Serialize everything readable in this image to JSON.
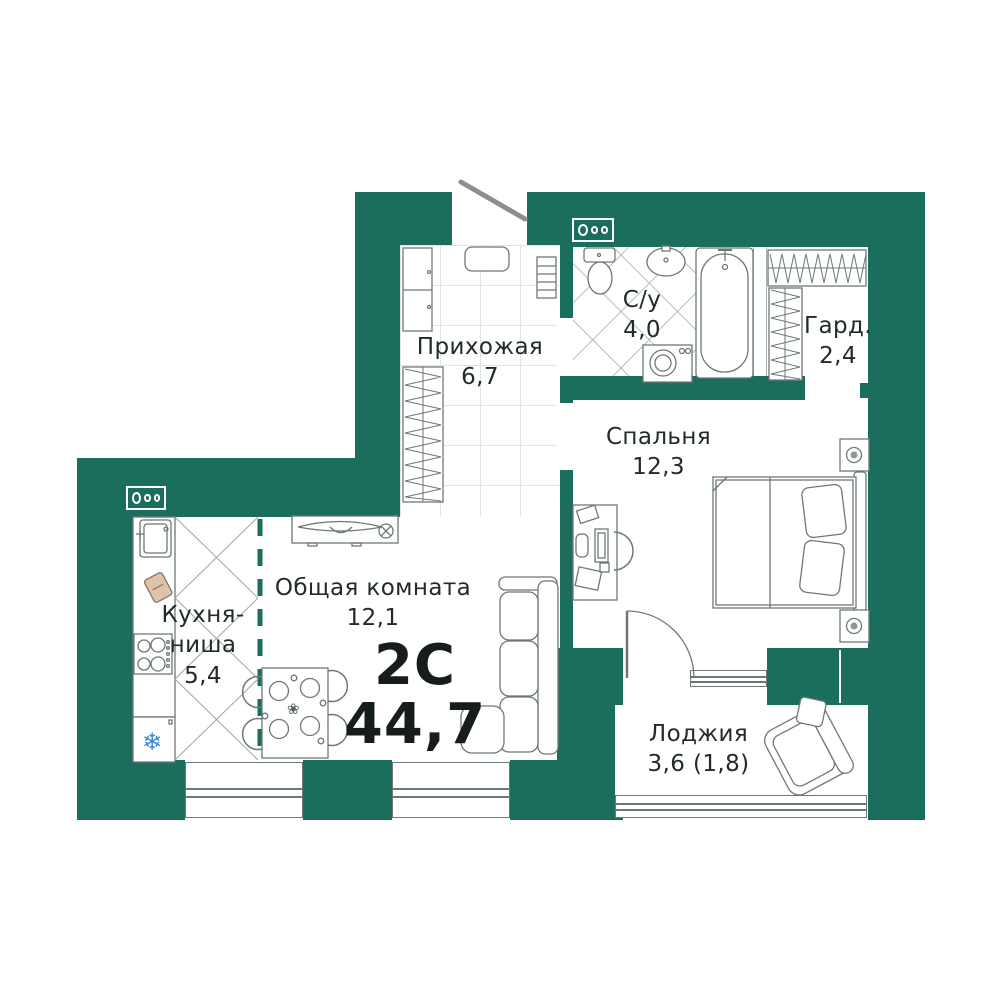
{
  "unit": {
    "type": "2С",
    "total_area": "44,7"
  },
  "rooms": {
    "hallway": {
      "name": "Прихожая",
      "area": "6,7"
    },
    "bathroom": {
      "name": "С/у",
      "area": "4,0"
    },
    "wardrobe": {
      "name": "Гард.",
      "area": "2,4"
    },
    "bedroom": {
      "name": "Спальня",
      "area": "12,3"
    },
    "living": {
      "name": "Общая комната",
      "area": "12,1"
    },
    "kitchen": {
      "name_line1": "Кухня-",
      "name_line2": "ниша",
      "area": "5,4"
    },
    "loggia": {
      "name": "Лоджия",
      "area": "3,6 (1,8)"
    }
  },
  "icons": {
    "snowflake": "❄",
    "flower": "❀"
  },
  "colors": {
    "wall": "#1B6E5C",
    "furniture_line": "#6d7878",
    "text": "#212b29",
    "cutting_board": "#dcc3ae",
    "snowflake_blue": "#3d87d6",
    "door_leaf_gray": "#8a8f8f"
  }
}
